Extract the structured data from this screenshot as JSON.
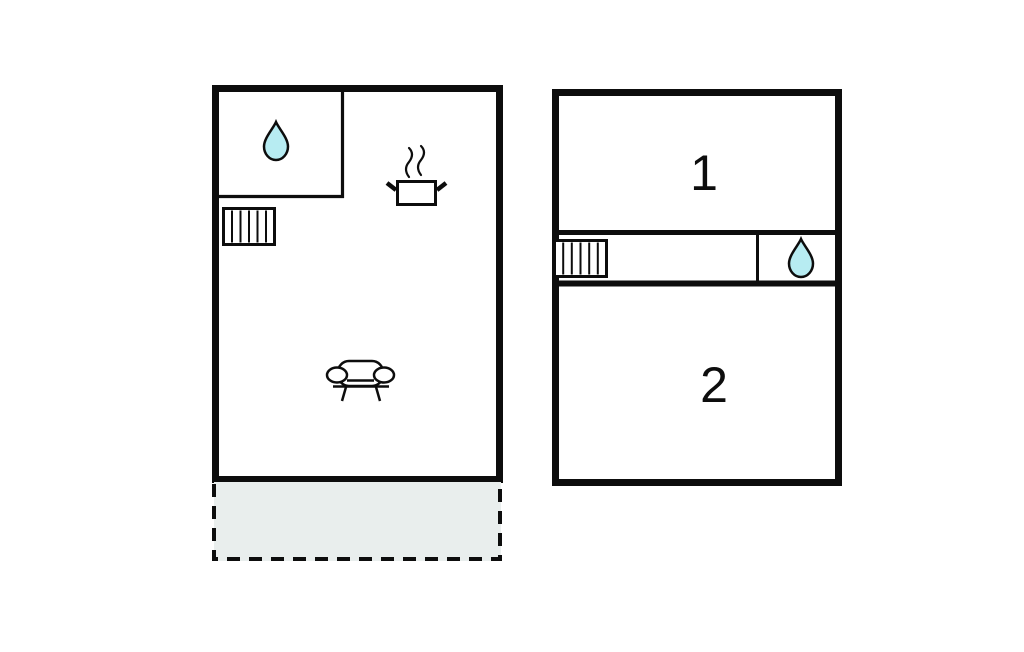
{
  "colors": {
    "wall": "#0d0d0d",
    "water_drop": "#b7ecf2",
    "terrace_fill": "#e9eeed",
    "background": "#ffffff"
  },
  "ground_floor": {
    "icons": [
      "water-drop",
      "stairs",
      "cooking-pot",
      "sofa"
    ],
    "terrace_dashed_area": true
  },
  "first_floor": {
    "room1_label": "1",
    "room2_label": "2",
    "icons": [
      "stairs",
      "water-drop"
    ]
  }
}
